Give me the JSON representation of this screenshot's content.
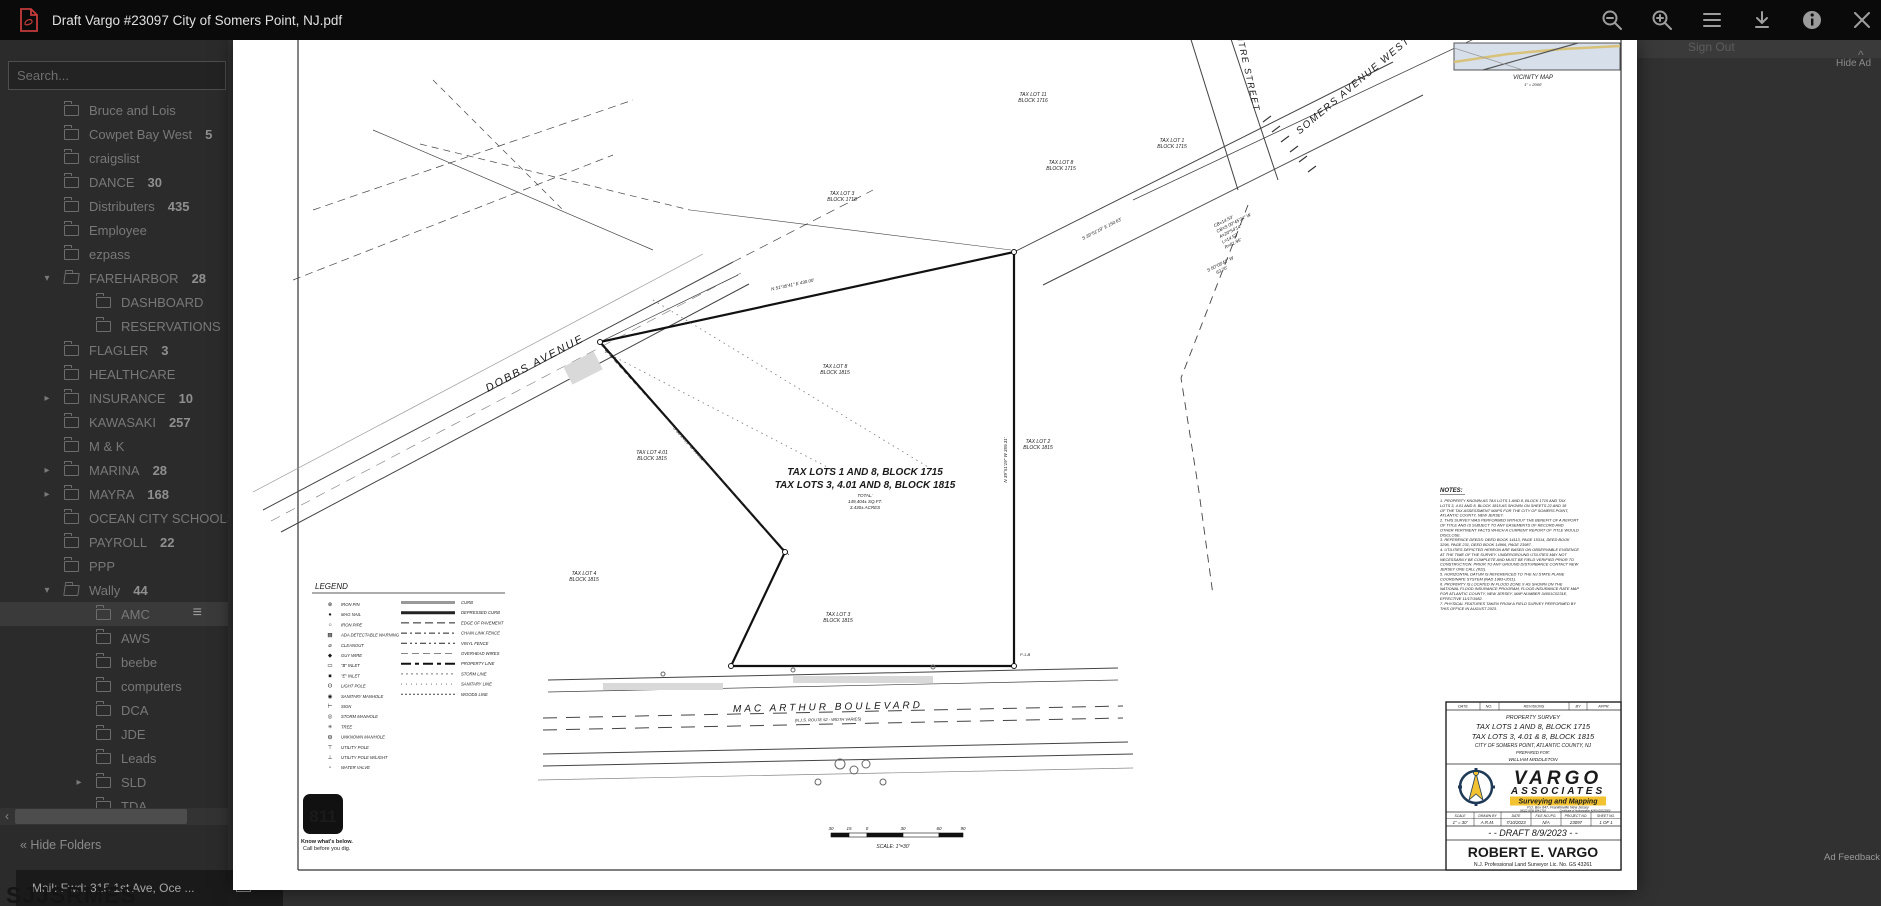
{
  "viewer": {
    "title": "Draft Vargo #23097 City of Somers Point, NJ.pdf"
  },
  "background": {
    "search_placeholder": "Search...",
    "sign_out_label": "Sign Out",
    "caret": "^",
    "hide_ad_label": "Hide Ad",
    "ad_feedback_label": "Ad Feedback",
    "hide_folders_label": "« Hide Folders",
    "taskbar_item_label": "Mail: Fwd: 315 1st Ave, Oce ...",
    "obscured_text": "SJJSRMES",
    "scroll_left_arrow": "‹",
    "folders": [
      {
        "label": "Bruce and Lois",
        "level": 1
      },
      {
        "label": "Cowpet Bay West",
        "count": "5",
        "level": 1
      },
      {
        "label": "craigslist",
        "level": 1
      },
      {
        "label": "DANCE",
        "count": "30",
        "level": 1
      },
      {
        "label": "Distributers",
        "count": "435",
        "level": 1
      },
      {
        "label": "Employee",
        "level": 1
      },
      {
        "label": "ezpass",
        "level": 1
      },
      {
        "label": "FAREHARBOR",
        "count": "28",
        "level": 1,
        "arrow": "down",
        "open": true
      },
      {
        "label": "DASHBOARD",
        "level": 2
      },
      {
        "label": "RESERVATIONS",
        "level": 2
      },
      {
        "label": "FLAGLER",
        "count": "3",
        "level": 1
      },
      {
        "label": "HEALTHCARE",
        "level": 1
      },
      {
        "label": "INSURANCE",
        "count": "10",
        "level": 1,
        "arrow": "right"
      },
      {
        "label": "KAWASAKI",
        "count": "257",
        "level": 1
      },
      {
        "label": "M & K",
        "level": 1
      },
      {
        "label": "MARINA",
        "count": "28",
        "level": 1,
        "arrow": "right"
      },
      {
        "label": "MAYRA",
        "count": "168",
        "level": 1,
        "arrow": "right"
      },
      {
        "label": "OCEAN CITY SCHOOLS",
        "level": 1
      },
      {
        "label": "PAYROLL",
        "count": "22",
        "level": 1
      },
      {
        "label": "PPP",
        "level": 1
      },
      {
        "label": "Wally",
        "count": "44",
        "level": 1,
        "arrow": "down",
        "open": true
      },
      {
        "label": "AMC",
        "level": 2,
        "active": true,
        "menu": true
      },
      {
        "label": "AWS",
        "level": 2
      },
      {
        "label": "beebe",
        "level": 2
      },
      {
        "label": "computers",
        "level": 2
      },
      {
        "label": "DCA",
        "level": 2
      },
      {
        "label": "JDE",
        "level": 2
      },
      {
        "label": "Leads",
        "level": 2
      },
      {
        "label": "SLD",
        "level": 2,
        "arrow": "right"
      },
      {
        "label": "TDA",
        "level": 2
      }
    ]
  },
  "survey": {
    "streets": {
      "dobbs": "DOBBS AVENUE",
      "macarthur": "MAC  ARTHUR    BOULEVARD",
      "macarthur_sub": "(N.J.S. ROUTE 52 - WIDTH VARIES)",
      "somers": "SOMERS AVENUE WEST",
      "centre": "CENTRE STREET"
    },
    "center_title": {
      "l1": "TAX LOTS 1 AND 8, BLOCK 1715",
      "l2": "TAX LOTS 3, 4.01 AND 8, BLOCK 1815",
      "l3": "TOTAL:",
      "l4": "149,404±  SQ.FT.",
      "l5": "3.430±  ACRES"
    },
    "lots": [
      {
        "l1": "TAX LOT 11",
        "l2": "BLOCK 1716"
      },
      {
        "l1": "TAX LOT 1",
        "l2": "BLOCK 1715"
      },
      {
        "l1": "TAX LOT 8",
        "l2": "BLOCK 1715"
      },
      {
        "l1": "TAX LOT 3",
        "l2": "BLOCK 1718"
      },
      {
        "l1": "TAX LOT 8",
        "l2": "BLOCK 1815"
      },
      {
        "l1": "TAX LOT 4.01",
        "l2": "BLOCK 1815"
      },
      {
        "l1": "TAX LOT 2",
        "l2": "BLOCK 1815"
      },
      {
        "l1": "TAX LOT 4",
        "l2": "BLOCK 1815"
      },
      {
        "l1": "TAX LOT 3",
        "l2": "BLOCK 1815"
      }
    ],
    "bearings": [
      "S 39°51'19\" E   150.63'",
      "CB=14.53'",
      "CB=S 00°45'34\" W",
      "A=20°54'14\"",
      "L=14.53'",
      "R=81.95'",
      "S 50°08'41\" W",
      "63.70'",
      "N 39°51'19\" W   359.31'",
      "S 38°24'21\" W   350.31'",
      "N 51°35'41\" E   430.00'",
      "P-1-B"
    ],
    "legend": {
      "title": "LEGEND",
      "symbols": [
        {
          "g": "⊗",
          "label": "IRON PIN"
        },
        {
          "g": "●",
          "label": "MAG NAIL"
        },
        {
          "g": "○",
          "label": "IRON PIPE"
        },
        {
          "g": "▦",
          "label": "ADA DETECTABLE WARNING"
        },
        {
          "g": "⌀",
          "label": "CLEANOUT"
        },
        {
          "g": "◆",
          "label": "GUY WIRE"
        },
        {
          "g": "▭",
          "label": "\"B\" INLET"
        },
        {
          "g": "■",
          "label": "\"E\" INLET"
        },
        {
          "g": "ʘ",
          "label": "LIGHT POLE"
        },
        {
          "g": "◉",
          "label": "SANITARY MANHOLE"
        },
        {
          "g": "⊢",
          "label": "SIGN"
        },
        {
          "g": "◎",
          "label": "STORM MANHOLE"
        },
        {
          "g": "✳",
          "label": "TREE"
        },
        {
          "g": "◍",
          "label": "UNKNOWN MANHOLE"
        },
        {
          "g": "⊤",
          "label": "UTILITY POLE"
        },
        {
          "g": "⊥",
          "label": "UTILITY POLE W/LIGHT"
        },
        {
          "g": "▫",
          "label": "WATER VALVE"
        }
      ],
      "lines": [
        {
          "label": "CURB"
        },
        {
          "label": "DEPRESSED CURB"
        },
        {
          "label": "EDGE OF PAVEMENT"
        },
        {
          "label": "CHAIN LINK FENCE"
        },
        {
          "label": "VINYL FENCE"
        },
        {
          "label": "OVERHEAD WIRES"
        },
        {
          "label": "PROPERTY LINE"
        },
        {
          "label": "STORM LINE"
        },
        {
          "label": "SANITARY LINE"
        },
        {
          "label": "WOODS LINE"
        }
      ]
    },
    "notes_title": "NOTES:",
    "notes_lines": [
      "1.  PROPERTY KNOWN AS TAX LOTS 1 AND 8, BLOCK 1715 AND TAX",
      "     LOTS 3, 4.01 AND 8, BLOCK 1815 AS SHOWN ON SHEETS 22 AND 18",
      "     OF THE TAX ASSESSMENT MAPS FOR THE CITY OF SOMERS POINT,",
      "     ATLANTIC COUNTY, NEW JERSEY.",
      "2.  THIS SURVEY WAS PERFORMED WITHOUT THE BENEFIT OF A REPORT",
      "     OF TITLE AND IS SUBJECT TO ANY EASEMENTS OF RECORD AND",
      "     OTHER PERTINENT FACTS WHICH A CURRENT REPORT OF TITLE WOULD",
      "     DISCLOSE.",
      "3.  REFERENCE DEEDS: DEED BOOK 14113, PAGE 15314, DEED BOOK",
      "     3296, PAGE 231, DEED BOOK 14966, PAGE 23987.",
      "4.  UTILITIES DEPICTED HEREON ARE BASED ON OBSERVABLE EVIDENCE",
      "     AT THE TIME OF THE SURVEY. UNDERGROUND UTILITIES MAY NOT",
      "     NECESSARILY BE COMPLETE AND MUST BE FIELD VERIFIED PRIOR TO",
      "     CONSTRUCTION. PRIOR TO ANY GROUND DISTURBANCE CONTACT NEW",
      "     JERSEY ONE CALL (811).",
      "5.  HORIZONTAL DATUM IS REFERENCED TO THE NJ STATE PLANE",
      "     COORDINATE SYSTEM (NAD 1983+2011).",
      "6.  PROPERTY IS LOCATED IN FLOOD ZONE X AS SHOWN ON THE",
      "     NATIONAL FLOOD INSURANCE PROGRAM, FLOOD INSURANCE RATE MAP",
      "     FOR ATLANTIC COUNTY, NEW JERSEY, MAP NUMBER 34001C0231E,",
      "     EFFECTIVE 11/17/1982.",
      "7.  PHYSICAL FEATURES TAKEN FROM A FIELD SURVEY PERFORMED BY",
      "     THIS OFFICE IN AUGUST 2023."
    ],
    "scalebar": {
      "numbers": [
        "30",
        "15",
        "0",
        "30",
        "60",
        "90"
      ],
      "caption": "SCALE: 1\"=30'"
    },
    "call811": {
      "number": "811",
      "l1": "Know what's below.",
      "l2": "Call before you dig."
    },
    "vicinity": {
      "title": "VICINITY MAP",
      "scale": "1\" = 2000'"
    },
    "title_block": {
      "rev_headers": [
        "DATE",
        "NO.",
        "REVISIONS",
        "BY",
        "APPR."
      ],
      "survey_type": "PROPERTY SURVEY",
      "lots1": "TAX LOTS 1 AND 8, BLOCK 1715",
      "lots2": "TAX LOTS 3, 4.01 & 8, BLOCK 1815",
      "municipality": "CITY OF SOMERS POINT, ATLANTIC COUNTY, NJ",
      "prepared_for_label": "PREPARED FOR:",
      "client": "WILLIAM MIDDLETON",
      "firm_name_1": "VARGO",
      "firm_name_2": "ASSOCIATES",
      "firm_tagline": "Surveying and Mapping",
      "firm_address": "P.O. Box 647, Franklinville New Jersey",
      "firm_phone": "08322   (856) 694-1716",
      "firm_cert": "Certificate of Authorization #24GA28223500",
      "param_headers": [
        "SCALE",
        "DRAWN  BY",
        "DATE",
        "FILE NO./PG.",
        "PROJECT NO.",
        "SHEET NO."
      ],
      "param_values": [
        "1\" = 30'",
        "A.R.M.",
        "7/10/2023",
        "N/A",
        "23097",
        "1  OF  1"
      ],
      "draft_line": "- - DRAFT 8/9/2023 - -",
      "surveyor": "ROBERT E. VARGO",
      "license": "N.J. Professional Land Surveyor Lic. No. GS 43261"
    },
    "colors": {
      "vargo_gray": "#64798a",
      "vargo_navy": "#1f3a57",
      "vargo_yellow": "#f2c230",
      "pdf_red": "#c43b3b"
    }
  }
}
